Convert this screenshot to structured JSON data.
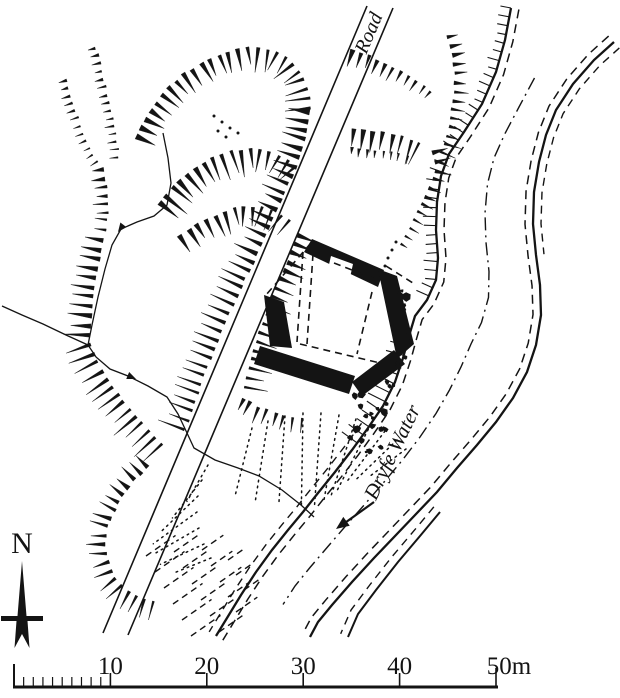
{
  "page": {
    "background": "#ffffff",
    "ink": "#141414"
  },
  "map": {
    "type": "archaeological-site-plan",
    "labels": {
      "road": "Road",
      "river": "Dryfe Water",
      "north": "N"
    },
    "scale_bar": {
      "tick_labels": [
        "10",
        "20",
        "30",
        "40",
        "50m"
      ],
      "tick_values": [
        10,
        20,
        30,
        40,
        50
      ],
      "unit": "m",
      "total_meters": 50,
      "subdivision_meters": 1
    }
  }
}
